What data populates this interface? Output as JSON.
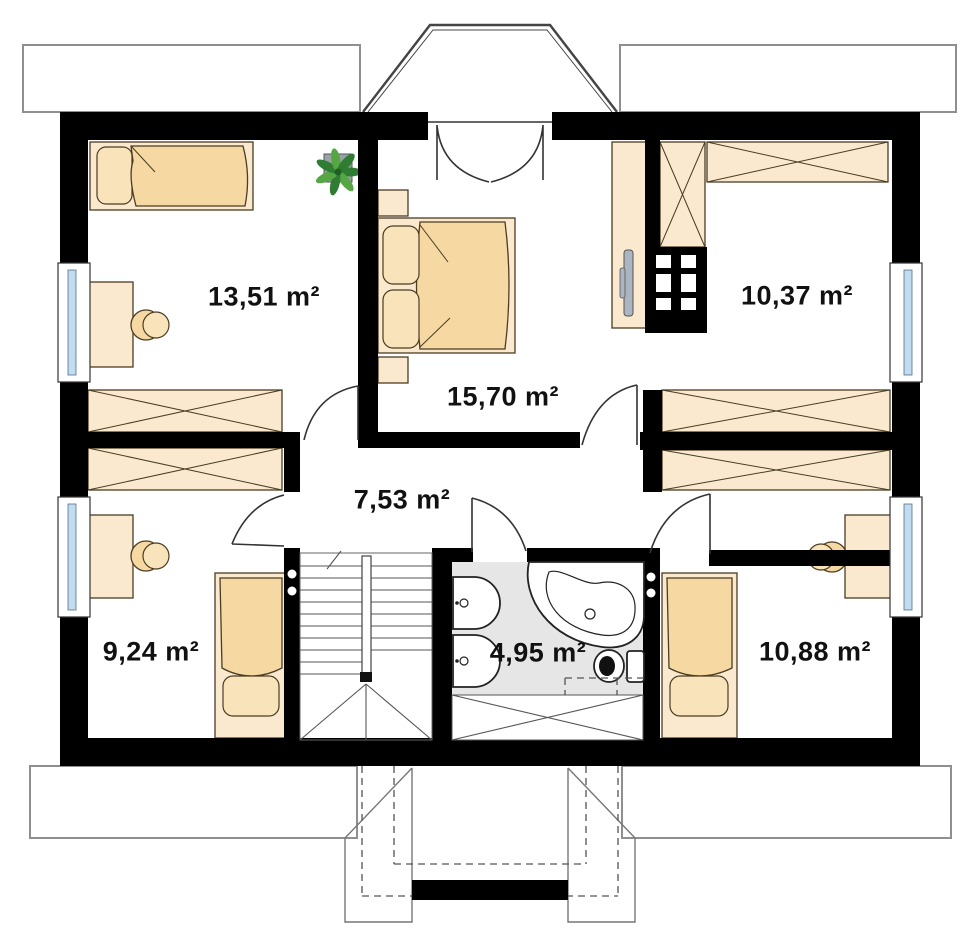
{
  "plan": {
    "kind": "attic-floor-plan",
    "area_unit": "m²"
  },
  "rooms": [
    {
      "id": "bedroom-top-left",
      "area": "13,51 m²"
    },
    {
      "id": "master-bedroom",
      "area": "15,70 m²"
    },
    {
      "id": "wardrobe-room",
      "area": "10,37 m²"
    },
    {
      "id": "hallway",
      "area": "7,53 m²"
    },
    {
      "id": "bedroom-bottom-left",
      "area": "9,24 m²"
    },
    {
      "id": "bathroom",
      "area": "4,95 m²"
    },
    {
      "id": "bedroom-bottom-right",
      "area": "10,88 m²"
    }
  ],
  "colors": {
    "wall": "#000000",
    "furniture_light": "#FAE9CF",
    "furniture_accent": "#F6D8A2",
    "furniture_pillow": "#F8E3BB",
    "bathroom_floor": "#E6E6E6",
    "window_glass": "#C2DCEF",
    "outline": "#4a3d22",
    "line": "#555555",
    "plant_green": "#2e7d32",
    "plant_green_light": "#56a644",
    "pot_gray": "#9aa2a8",
    "tv_gray": "#ADB5C0"
  }
}
